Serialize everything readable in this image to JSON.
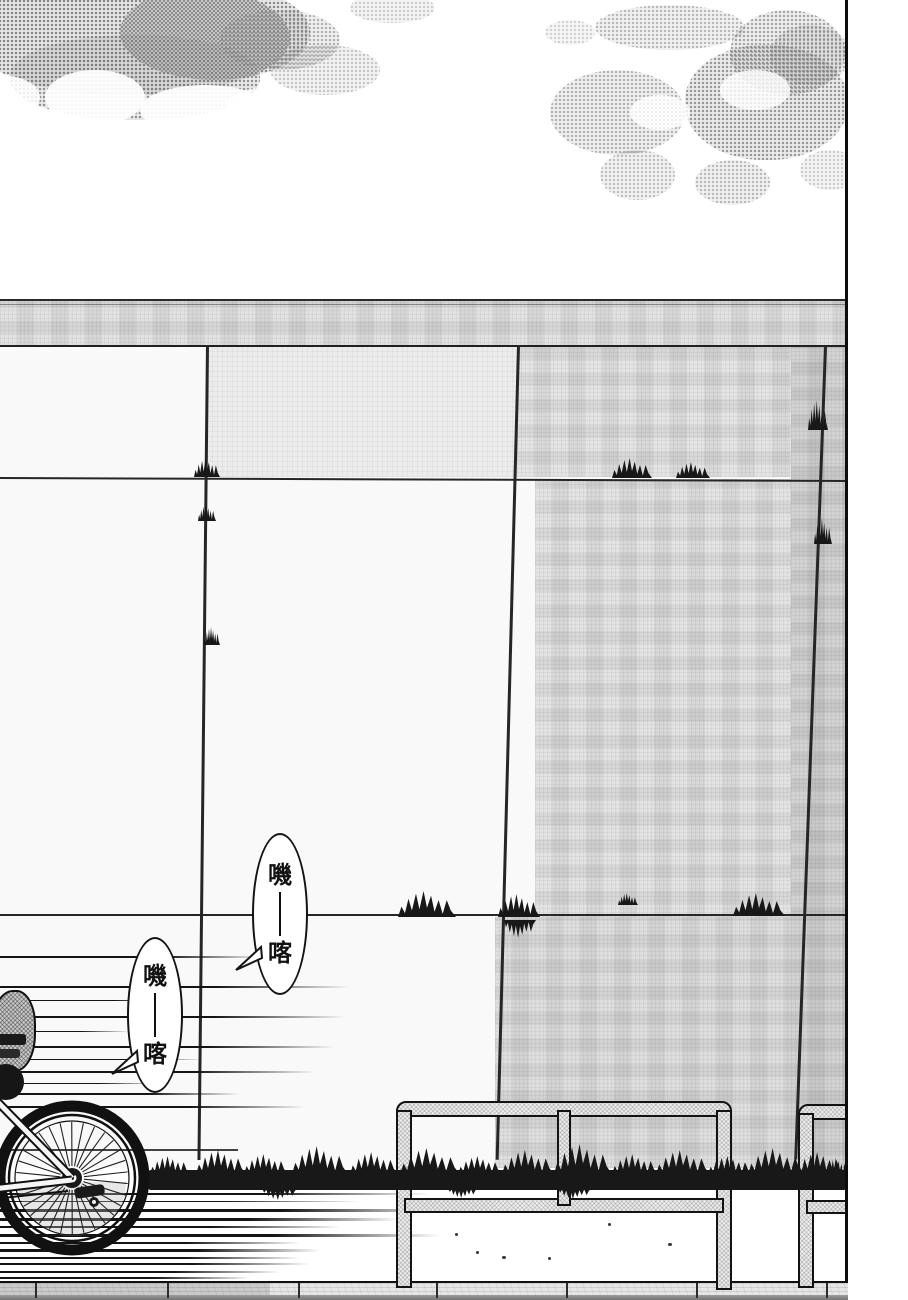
{
  "page": {
    "kind": "manga page panel",
    "width_px": 908,
    "height_px": 1300
  },
  "sfx_bubbles": [
    {
      "name": "sfx-bubble-1",
      "full_text": "嘰——喀",
      "top_char": "嘰",
      "bottom_char": "喀"
    },
    {
      "name": "sfx-bubble-2",
      "full_text": "嘰——喀",
      "top_char": "嘰",
      "bottom_char": "喀"
    }
  ],
  "scene_elements": {
    "clouds": "halftone cloud masses top-left and top-right",
    "wall": "large tiled concrete wall with horizontal beam and tile joints",
    "railing": "two metal guard-rail segments on a curb",
    "grass": "dark grass strip at wall base and clumps along tile joints",
    "bicycle": "rear wheel and frame of a bicycle speeding out of frame to the left",
    "speed_lines": "horizontal motion lines behind the bicycle",
    "curb": "stone curb strip across the bottom edge"
  },
  "colors": {
    "paper": "#ffffff",
    "ink": "#141414",
    "halftone_gray": "#7d7d7d",
    "wall_light": "#ececec",
    "wall_dark": "#d2d2d2",
    "grass_ink": "#181818",
    "metal_gray": "#ededed"
  }
}
